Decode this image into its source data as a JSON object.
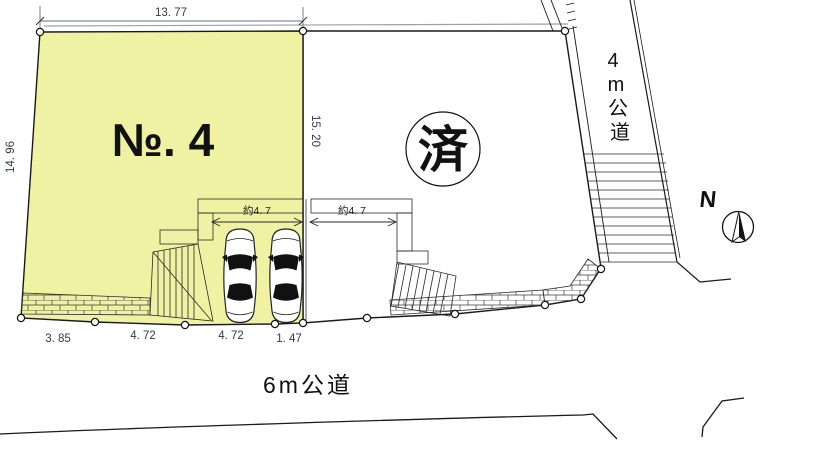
{
  "drawing": {
    "plot1": {
      "label": "№. 4",
      "fill": "#eef2a2",
      "dim_top": "13. 77",
      "dim_left": "14. 96",
      "dim_right": "15. 20",
      "dims_bottom": [
        "3. 85",
        "4. 72",
        "4. 72",
        "1. 47"
      ],
      "parking_dim": "約4. 7"
    },
    "plot2": {
      "label": "済",
      "parking_dim": "約4. 7"
    },
    "road_east": {
      "chars": [
        "4",
        "m",
        "公",
        "道"
      ]
    },
    "road_south": {
      "label": "6m公道"
    },
    "compass": {
      "label": "N"
    },
    "colors": {
      "plot1_fill": "#eef2a2",
      "line": "#1a1a1a",
      "double_line_gray": "#9aa0a8",
      "dim_text": "#333a44"
    }
  }
}
